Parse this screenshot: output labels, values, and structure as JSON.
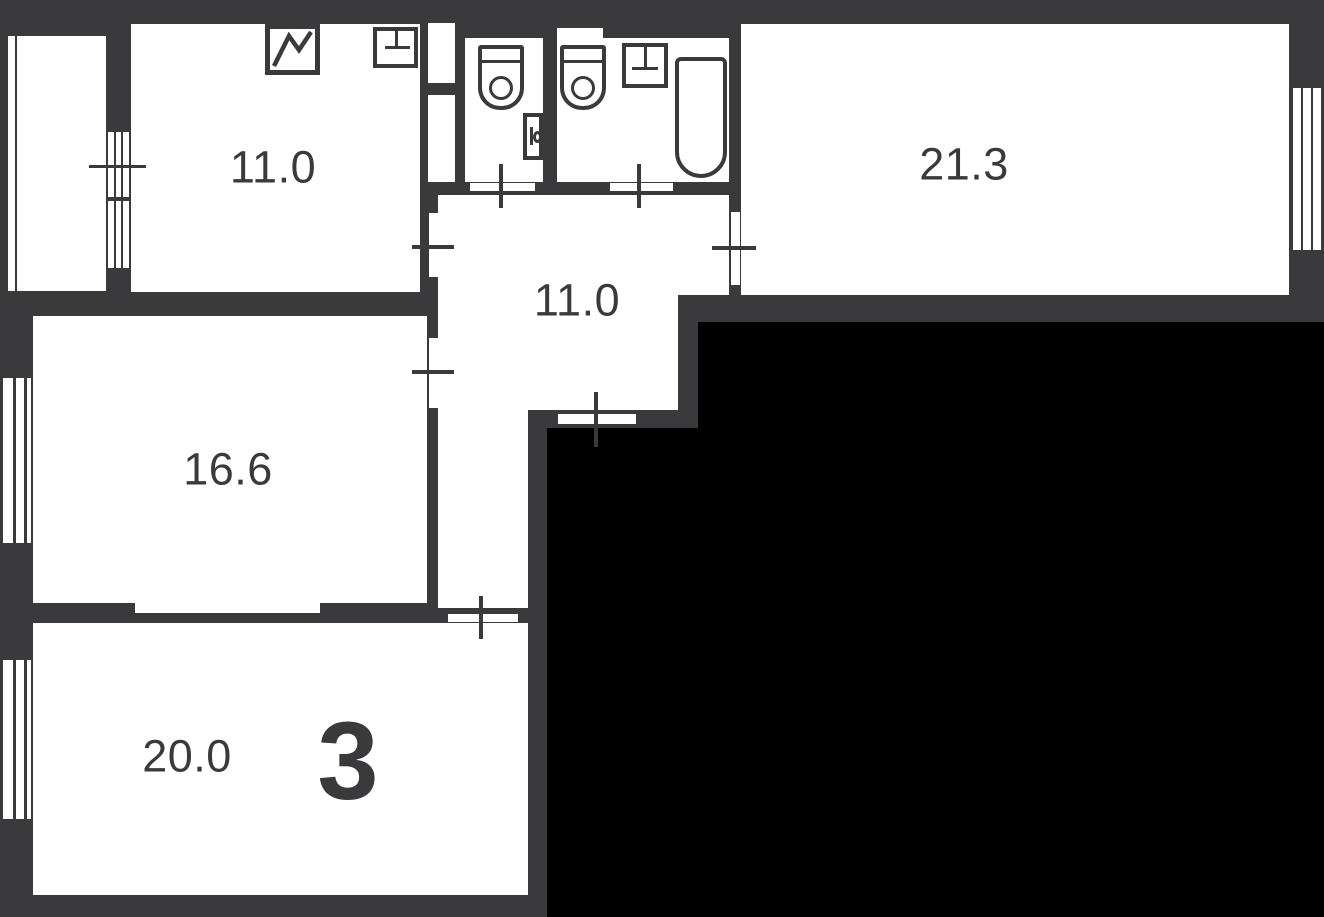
{
  "floorplan": {
    "room_count": "3",
    "rooms": [
      {
        "name": "kitchen",
        "area": "11.0"
      },
      {
        "name": "living-room",
        "area": "21.3"
      },
      {
        "name": "hallway",
        "area": "11.0"
      },
      {
        "name": "bedroom-1",
        "area": "16.6"
      },
      {
        "name": "bedroom-2",
        "area": "20.0"
      }
    ],
    "colors": {
      "wall": "#3A3A3C",
      "floor": "#FFFFFF",
      "masked_area": "#000000"
    }
  }
}
